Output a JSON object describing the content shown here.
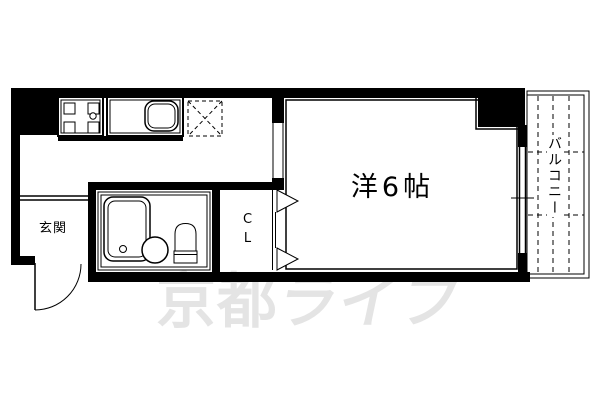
{
  "floorplan": {
    "labels": {
      "entrance": "玄関",
      "main_room": "洋6帖",
      "closet": "CL",
      "balcony": "バルコニー"
    },
    "watermark": {
      "part1": "京都",
      "part2": "ライフ",
      "color": "#e4e4e4"
    },
    "icons": {
      "stove": "stove-burner-icon",
      "sink": "kitchen-sink-icon",
      "refrigerator": "refrigerator-space-icon",
      "bathtub": "bathtub-icon",
      "basin": "wash-basin-icon",
      "toilet": "toilet-icon",
      "door": "entrance-door-swing-icon",
      "window": "sliding-window-icon",
      "closet_door": "folding-door-icon"
    },
    "colors": {
      "line": "#000000",
      "background": "#ffffff"
    }
  }
}
